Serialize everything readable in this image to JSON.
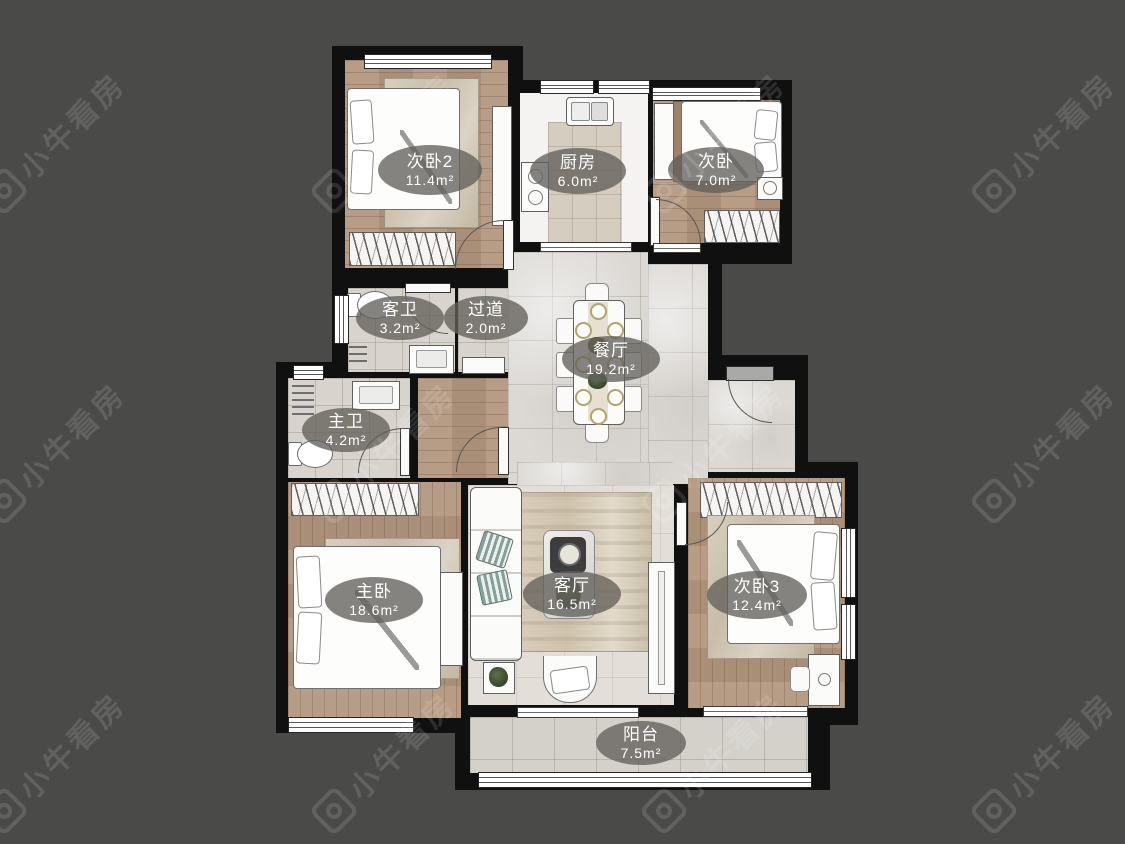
{
  "canvas": {
    "width": 1125,
    "height": 844,
    "background": "#4a4a49",
    "wall_color": "#101010",
    "label_bg": "rgba(99,96,91,0.78)"
  },
  "watermark": {
    "text": "小牛看房"
  },
  "rooms": [
    {
      "id": "bedroom2",
      "name": "次卧2",
      "area": "11.4m²"
    },
    {
      "id": "kitchen",
      "name": "厨房",
      "area": "6.0m²"
    },
    {
      "id": "bedroom",
      "name": "次卧",
      "area": "7.0m²"
    },
    {
      "id": "guest-bath",
      "name": "客卫",
      "area": "3.2m²"
    },
    {
      "id": "hallway",
      "name": "过道",
      "area": "2.0m²"
    },
    {
      "id": "dining",
      "name": "餐厅",
      "area": "19.2m²"
    },
    {
      "id": "master-bath",
      "name": "主卫",
      "area": "4.2m²"
    },
    {
      "id": "master-bedroom",
      "name": "主卧",
      "area": "18.6m²"
    },
    {
      "id": "living",
      "name": "客厅",
      "area": "16.5m²"
    },
    {
      "id": "bedroom3",
      "name": "次卧3",
      "area": "12.4m²"
    },
    {
      "id": "balcony",
      "name": "阳台",
      "area": "7.5m²"
    }
  ]
}
